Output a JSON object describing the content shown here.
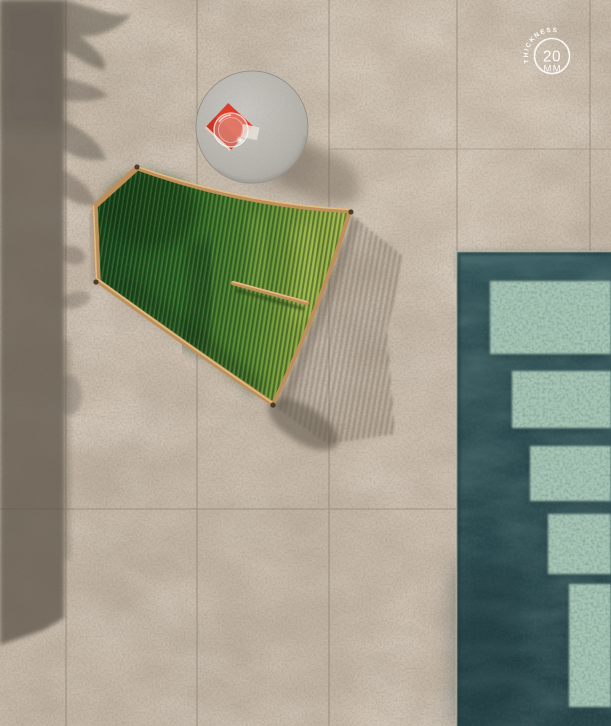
{
  "meta": {
    "type": "product-photograph",
    "view": "top-down aerial",
    "subject": "Outdoor stone-effect 20 mm porcelain pavers laid around a pool, with a green woven sun lounger, a round side table with a red book and glass bowl, and tree shadows at left"
  },
  "badge": {
    "arc_label": "THICKNESS",
    "value": "20",
    "unit": "MM",
    "color": "#ffffff"
  },
  "palette": {
    "tile_base": "#c7b9a8",
    "tile_grout": "#8c8071",
    "shade": "#5b544a",
    "pool_water": "#2c4b50",
    "pool_water_deep": "#223e43",
    "pool_step": "#a7c6b5",
    "pool_step_shadow": "#203b3f",
    "chair_green_dark": "#1a4d1f",
    "chair_green_light": "#a8bd4f",
    "chair_frame": "#c0905a",
    "chair_frame_light": "#ecc98e",
    "table_top": "#bab7b1",
    "book_red": "#e23b28",
    "shadow": "#6a6052"
  },
  "pool": {
    "x": 456,
    "y": 251,
    "width": 155,
    "height": 475,
    "steps": [
      {
        "x": 490,
        "y": 281,
        "w": 121,
        "h": 73
      },
      {
        "x": 512,
        "y": 371,
        "w": 99,
        "h": 57
      },
      {
        "x": 530,
        "y": 446,
        "w": 81,
        "h": 55
      },
      {
        "x": 548,
        "y": 514,
        "w": 63,
        "h": 60
      },
      {
        "x": 569,
        "y": 584,
        "w": 42,
        "h": 123
      }
    ]
  },
  "objects": {
    "lounger": {
      "label": "green corded sun lounger with wooden frame"
    },
    "table": {
      "label": "round concrete side table with red book and glass bowl"
    },
    "pool": {
      "label": "swimming pool with submerged steps"
    },
    "shadows": {
      "label": "wall and foliage shadows on pavers"
    }
  }
}
